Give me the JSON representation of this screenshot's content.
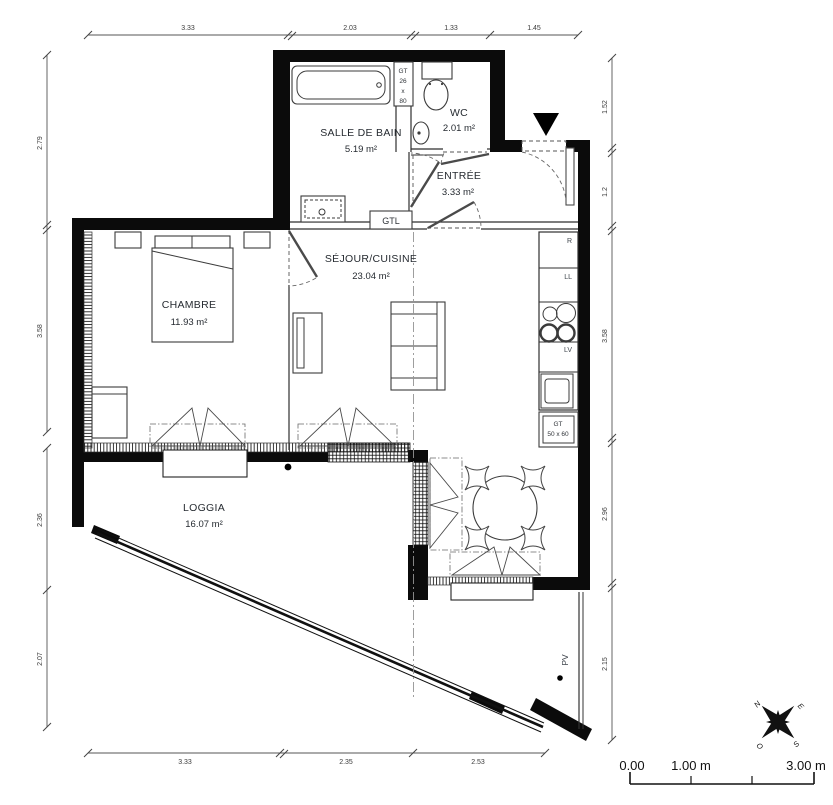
{
  "plan": {
    "title": "apartment-floor-plan",
    "rooms": [
      {
        "id": "salle-de-bain",
        "name": "SALLE DE BAIN",
        "area": "5.19 m²"
      },
      {
        "id": "wc",
        "name": "WC",
        "area": "2.01 m²"
      },
      {
        "id": "entree",
        "name": "ENTRÉE",
        "area": "3.33 m²"
      },
      {
        "id": "sejour-cuisine",
        "name": "SÉJOUR/CUISINE",
        "area": "23.04 m²"
      },
      {
        "id": "chambre",
        "name": "CHAMBRE",
        "area": "11.93 m²"
      },
      {
        "id": "loggia",
        "name": "LOGGIA",
        "area": "16.07 m²"
      }
    ],
    "fixtures": {
      "gtl": "GTL",
      "gt_column": [
        "GT",
        "26",
        "x",
        "80"
      ],
      "gt_floor": [
        "GT",
        "50 x 60"
      ],
      "appliances": {
        "fridge": "R",
        "washer": "LL",
        "dishwasher": "LV"
      },
      "pv": "PV"
    },
    "dimensions": {
      "top": [
        "3.33",
        "2.03",
        "1.33",
        "1.45"
      ],
      "left": [
        "2.79",
        "3.58",
        "2.36",
        "2.07"
      ],
      "right": [
        "1.52",
        "1.2",
        "3.58",
        "2.96",
        "2.15"
      ],
      "bottom": [
        "3.33",
        "2.35",
        "2.53"
      ]
    },
    "scale_bar": {
      "labels": [
        "0.00",
        "1.00 m",
        "3.00 m"
      ]
    },
    "compass": {
      "n": "N",
      "e": "E",
      "s": "S",
      "o": "O"
    },
    "colors": {
      "wall": "#0b0b0b",
      "line": "#2f2f2f",
      "label": "#262b31",
      "dim": "#3c3c3c"
    }
  }
}
